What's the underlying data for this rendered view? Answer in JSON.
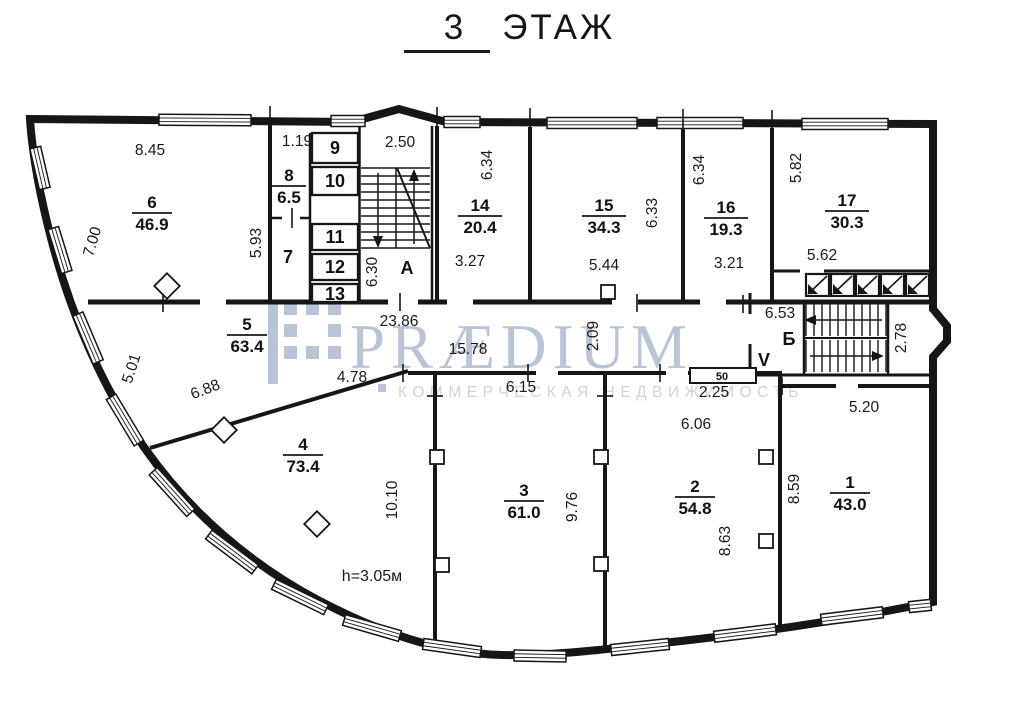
{
  "title": {
    "number": "3",
    "word": "ЭТАЖ"
  },
  "watermark": {
    "brand": "PRÆDIUM",
    "subtitle": "КОММЕРЧЕСКАЯ НЕДВИЖИМОСТЬ",
    "brand_color": "#b5c2d4",
    "subtitle_color": "#c9d2dd"
  },
  "rooms": [
    {
      "number": "6",
      "area": "46.9"
    },
    {
      "number": "8",
      "area": "6.5"
    },
    {
      "number": "5",
      "area": "63.4"
    },
    {
      "number": "14",
      "area": "20.4"
    },
    {
      "number": "15",
      "area": "34.3"
    },
    {
      "number": "16",
      "area": "19.3"
    },
    {
      "number": "17",
      "area": "30.3"
    },
    {
      "number": "4",
      "area": "73.4"
    },
    {
      "number": "3",
      "area": "61.0"
    },
    {
      "number": "2",
      "area": "54.8"
    },
    {
      "number": "1",
      "area": "43.0"
    }
  ],
  "cabins": [
    "7",
    "9",
    "10",
    "11",
    "12",
    "13"
  ],
  "stairs": {
    "a": "А",
    "b": "Б",
    "v": "V",
    "shaft": "50"
  },
  "labels": {
    "height": "h=3.05м"
  },
  "dims": [
    "8.45",
    "7.00",
    "1.19",
    "2.50",
    "5.93",
    "6.30",
    "6.34",
    "3.27",
    "6.33",
    "5.44",
    "6.34",
    "3.21",
    "5.82",
    "5.62",
    "23.86",
    "15.78",
    "2.09",
    "6.53",
    "2.78",
    "5.01",
    "6.88",
    "4.78",
    "6.15",
    "2.25",
    "6.06",
    "10.10",
    "9.76",
    "8.63",
    "8.59",
    "5.20"
  ]
}
